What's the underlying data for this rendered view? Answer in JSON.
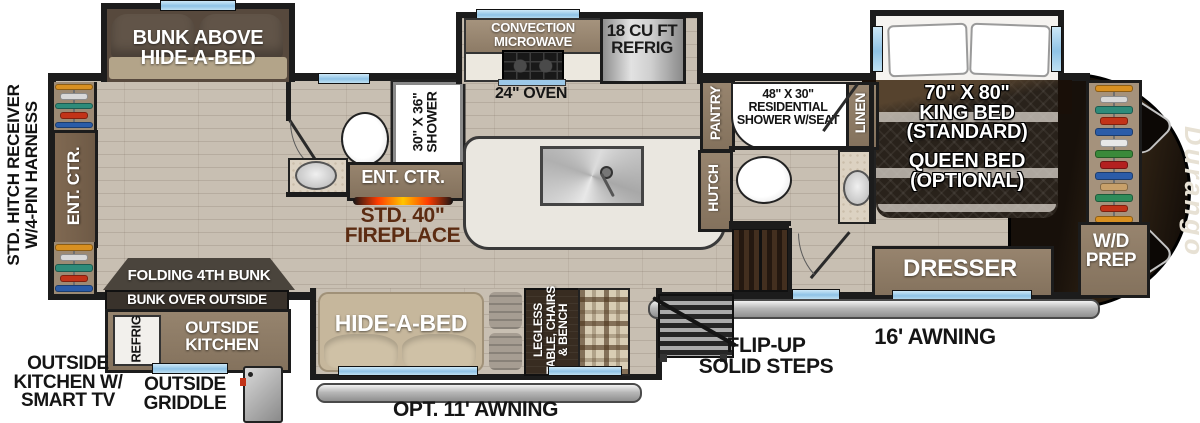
{
  "plan": {
    "hitch_label": "STD. HITCH RECEIVER\nW/4-PIN HARNESS",
    "brand": "Durango",
    "bunk_slide": {
      "label": "BUNK ABOVE\nHIDE-A-BED"
    },
    "left_wall": {
      "ent_ctr": "ENT. CTR."
    },
    "rear_bath": {
      "shower": "30\" X 36\"\nSHOWER"
    },
    "living": {
      "ent_ctr": "ENT. CTR.",
      "fireplace": "STD. 40\"\nFIREPLACE"
    },
    "kitchen": {
      "microwave": "CONVECTION\nMICROWAVE",
      "oven": "24\" OVEN",
      "refrig": "18 CU FT\nREFRIG",
      "pantry": "PANTRY",
      "hutch": "HUTCH"
    },
    "main_bath": {
      "shower": "48\" X 30\"\nRESIDENTIAL\nSHOWER W/SEAT",
      "linen": "LINEN"
    },
    "bedroom": {
      "king": "70\" X 80\"\nKING BED\n(STANDARD)",
      "queen": "QUEEN BED\n(OPTIONAL)",
      "dresser": "DRESSER",
      "wd_prep": "W/D\nPREP"
    },
    "outside_kitchen": {
      "folding_bunk": "FOLDING 4TH BUNK",
      "bunk_over": "BUNK OVER OUTSIDE KITCHEN",
      "refrig": "REFRIG",
      "kitchen": "OUTSIDE\nKITCHEN",
      "note": "OUTSIDE\nKITCHEN W/\nSMART TV",
      "griddle": "OUTSIDE\nGRIDDLE"
    },
    "dinette_slide": {
      "sofa": "HIDE-A-BED",
      "table": "LEGLESS\nTABLE, CHAIRS\n& BENCH"
    },
    "exterior": {
      "awning_rear": "OPT. 11' AWNING",
      "awning_main": "16' AWNING",
      "steps": "FLIP-UP\nSOLID STEPS"
    },
    "colors": {
      "wall": "#1c1c1c",
      "floor": "#c8bfb2",
      "cabinet": "#8a7866",
      "window_blue": "#a9d3ee",
      "flame_orange": "#ff7a00",
      "fireplace_text": "#5c2c12",
      "cap_dark": "#1f150d"
    },
    "hanger_colors": [
      "#d89021",
      "#d8d8d8",
      "#2e8b7a",
      "#c23318",
      "#2b5ca8",
      "#e8e8e8",
      "#3a8a3a",
      "#b32020",
      "#2b5ca8",
      "#c8a06a",
      "#2e8b5a",
      "#c23318",
      "#d89021"
    ]
  }
}
